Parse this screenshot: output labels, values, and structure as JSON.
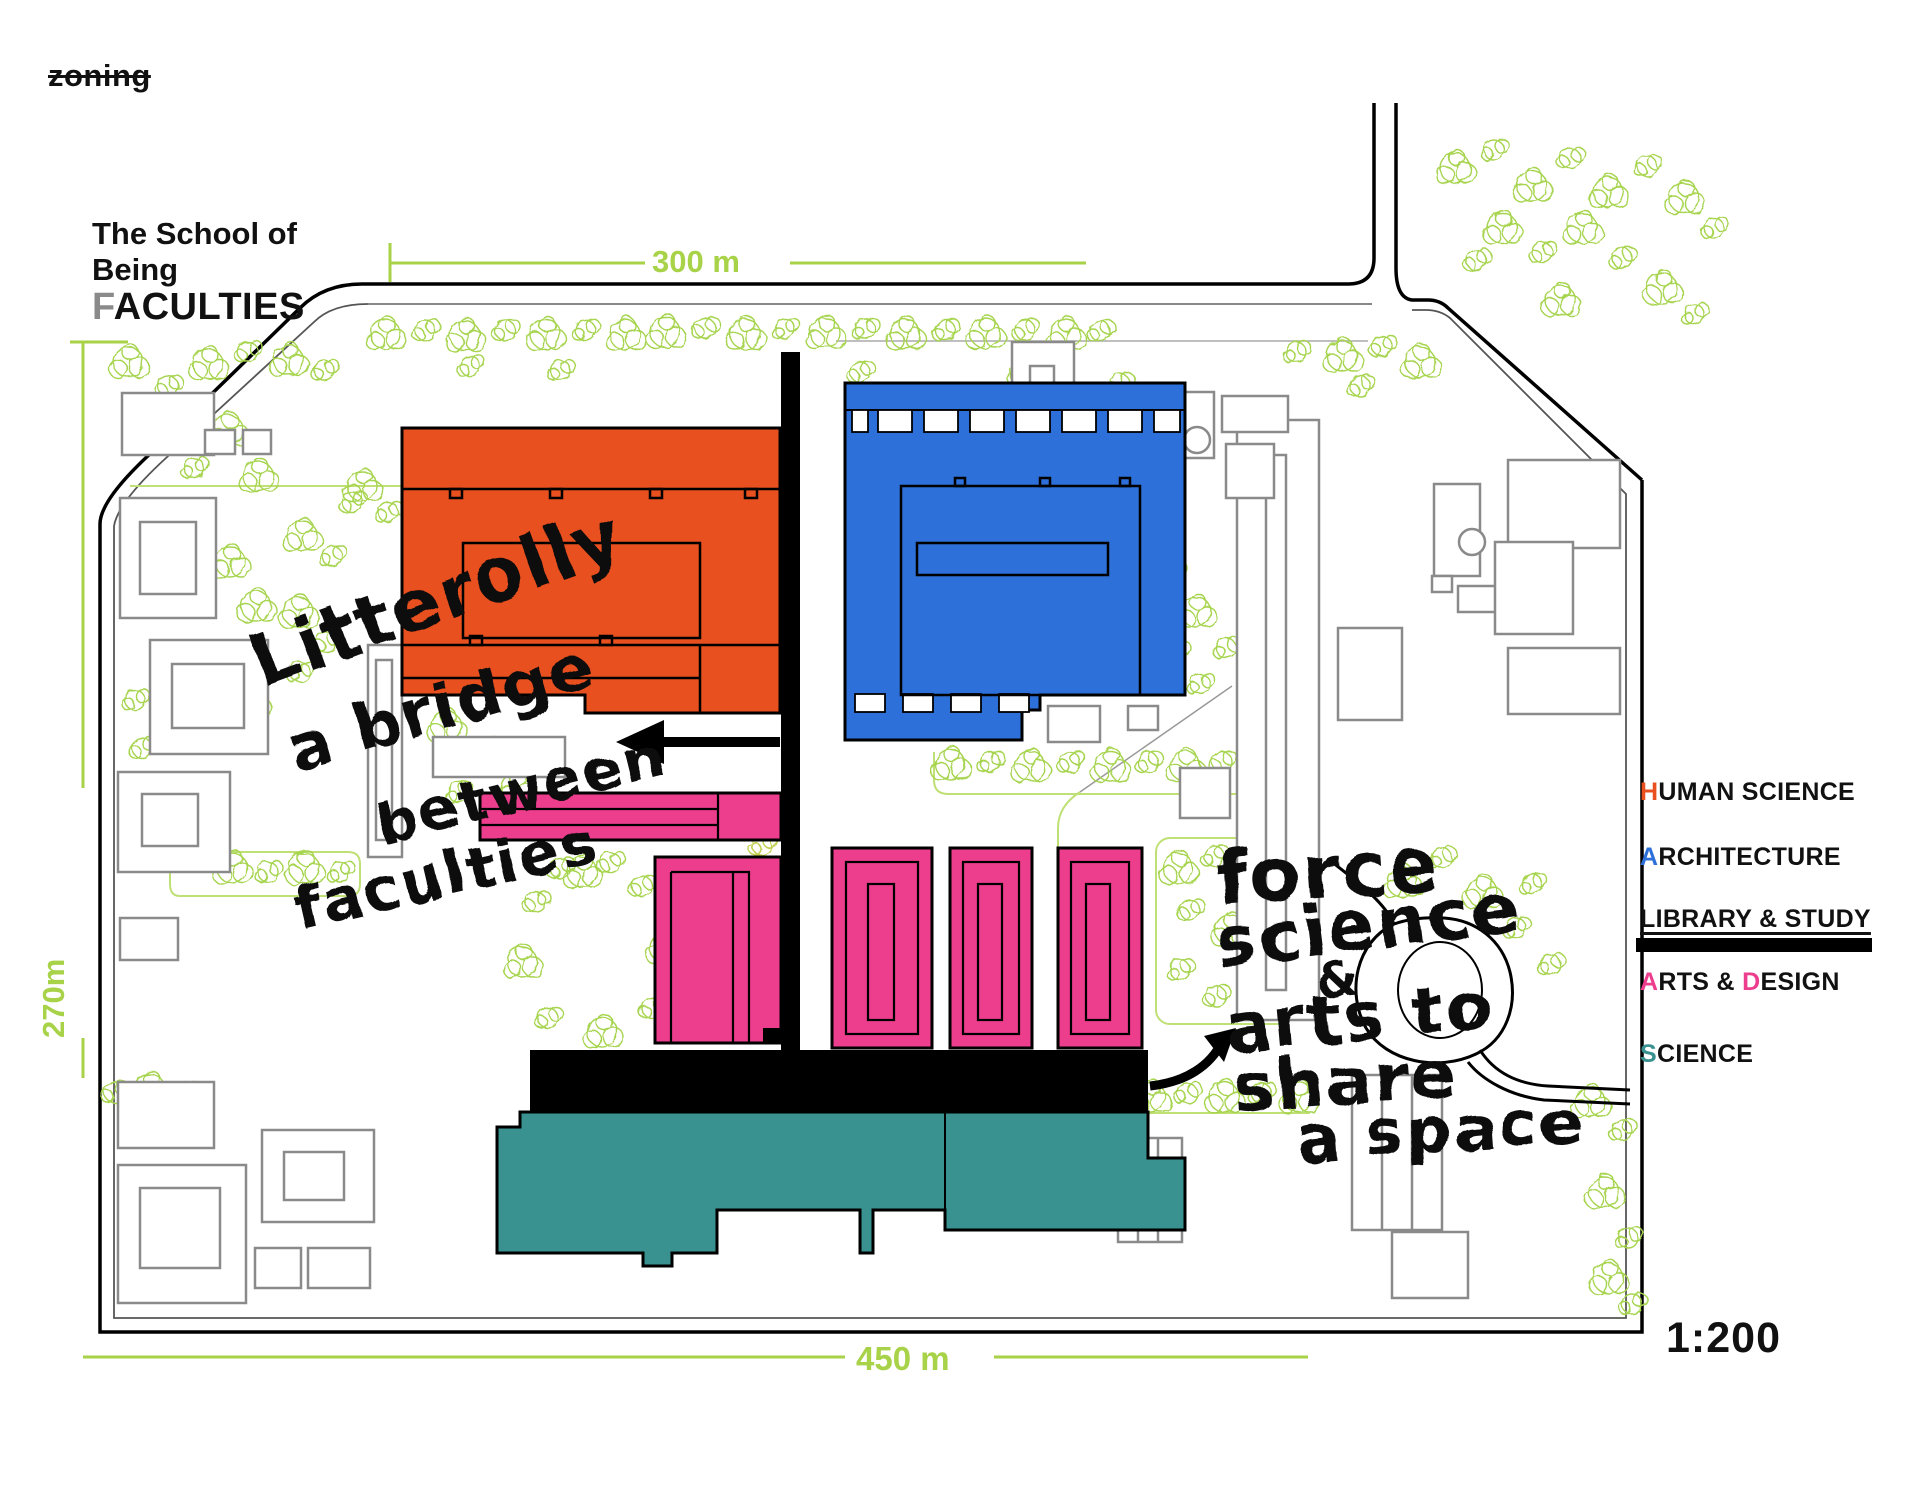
{
  "title": {
    "tag": "zoning",
    "line1": "The School of",
    "line2": "Being",
    "f_first": "F",
    "f_rest": "ACULTIES"
  },
  "dimensions": {
    "top": "300 m",
    "left": "270m",
    "bottom": "450 m",
    "scale": "1:200"
  },
  "legend": {
    "human_science": {
      "first": "H",
      "rest": "UMAN SCIENCE"
    },
    "architecture": {
      "first": "A",
      "rest": "RCHITECTURE"
    },
    "library_study": {
      "label": "LIBRARY & STUDY"
    },
    "arts_design": {
      "s1": "A",
      "s2": "RTS & ",
      "s3": "D",
      "s4": "ESIGN"
    },
    "science": {
      "first": "S",
      "rest": "CIENCE"
    }
  },
  "annotations": {
    "bridge_note": {
      "line1": "Litterolly",
      "line2": "a bridge",
      "line3": "between",
      "line4": "faculties"
    },
    "share_note": {
      "line1": "force",
      "line2": "science",
      "line3": "&",
      "line4": "arts to",
      "line5": "share",
      "line6": "a space"
    }
  },
  "colors": {
    "human_science": "#E8501F",
    "architecture": "#2E70D9",
    "arts_design": "#ED3D8D",
    "science": "#399190",
    "library_study": "#000000",
    "dimension_green": "#A8D248",
    "tree_green": "#A6D44E",
    "context_gray": "#8A8A8A",
    "faculties_f_gray": "#8A8A8A"
  }
}
